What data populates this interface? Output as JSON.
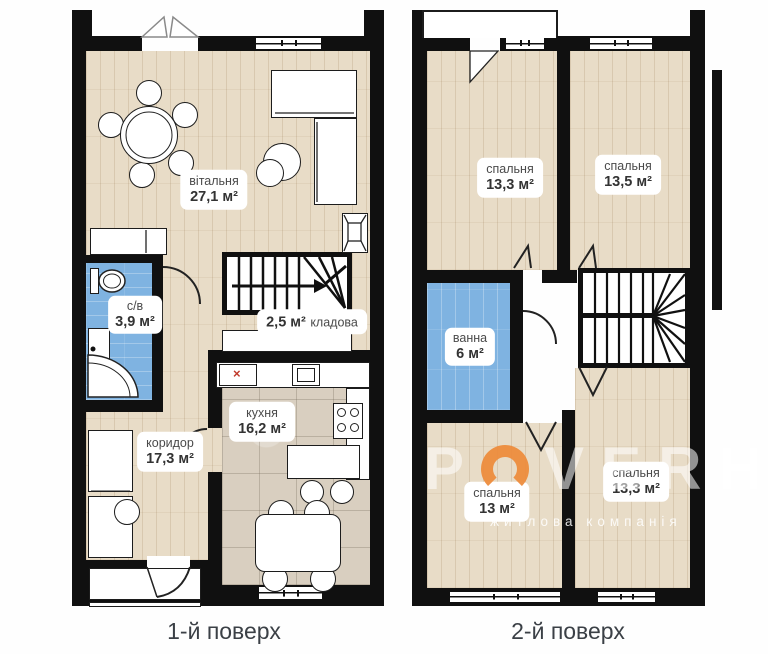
{
  "captions": {
    "floor1": "1-й поверх",
    "floor2": "2-й поверх"
  },
  "colors": {
    "wall": "#101010",
    "wood_floor": "#e8dcc7",
    "kitchen_tile": "#d9cfc0",
    "bathroom_blue": "#7fb3e1",
    "accent_orange": "#ee8d3e",
    "label_text": "#4a4a4a",
    "caption_text": "#3b4046",
    "marker_red": "#c0392b"
  },
  "floor1": {
    "rooms": [
      {
        "id": "living",
        "name": "вітальня",
        "area": "27,1 м²"
      },
      {
        "id": "wc",
        "name": "с/в",
        "area": "3,9 м²"
      },
      {
        "id": "storage",
        "name": "кладова",
        "area": "2,5 м²"
      },
      {
        "id": "kitchen",
        "name": "кухня",
        "area": "16,2 м²"
      },
      {
        "id": "corridor",
        "name": "коридор",
        "area": "17,3 м²"
      }
    ],
    "markers": {
      "appliance_x": "×"
    }
  },
  "floor2": {
    "rooms": [
      {
        "id": "bedroom1",
        "name": "спальня",
        "area": "13,3 м²"
      },
      {
        "id": "bedroom2",
        "name": "спальня",
        "area": "13,5 м²"
      },
      {
        "id": "bath",
        "name": "ванна",
        "area": "6 м²"
      },
      {
        "id": "bedroom3",
        "name": "спальня",
        "area": "13 м²"
      },
      {
        "id": "bedroom4",
        "name": "спальня",
        "area": "13,3 м²"
      }
    ]
  },
  "watermark": {
    "letters": [
      "P",
      "O",
      "V",
      "E",
      "R",
      "H"
    ],
    "subtitle": "житлова компанія"
  }
}
